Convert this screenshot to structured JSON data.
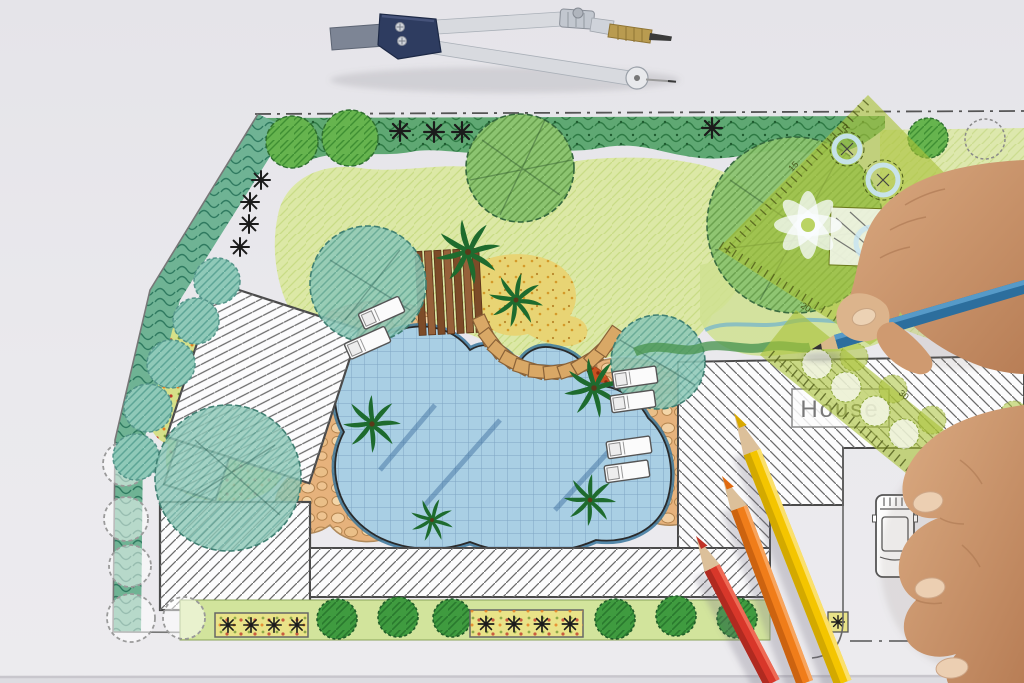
{
  "scene": {
    "subject": "Landscape architect garden design plan photographed with drafting tools and hands",
    "house_label": "House",
    "template_markings": [
      "15",
      "20",
      "30",
      "R"
    ],
    "objects": [
      "drafting-compass",
      "garden-plan",
      "swimming-pool",
      "house-footprint",
      "green-drafting-template",
      "scale-ruler",
      "blue-pencil",
      "red-pencil",
      "orange-pencil",
      "yellow-pencil",
      "right-hand-holding-pencil",
      "left-hand-resting",
      "car-parking",
      "lawn",
      "palm-trees",
      "lounge-chairs"
    ],
    "colors": {
      "paper": "#e9e8ec",
      "lawn": "#dce8a6",
      "shrub_border": "#5fa873",
      "teal_tree": "#8fc9b8",
      "pool_water": "#a9cfe4",
      "pool_edge": "#38759c",
      "stone_paving": "#e6b27c",
      "red_groundcover": "#c85020",
      "deck_wood": "#8a5a30",
      "palm_green": "#1e6b2e",
      "hatch_line": "#6b6b6b",
      "template_green": "#a9c238",
      "pencil_blue": "#2c6e9d",
      "pencil_red": "#d8372a",
      "pencil_orange": "#f07d1a",
      "pencil_yellow": "#f4c500",
      "compass_navy": "#2e3c60",
      "compass_silver": "#d8dadf",
      "skin": "#c89068"
    }
  }
}
